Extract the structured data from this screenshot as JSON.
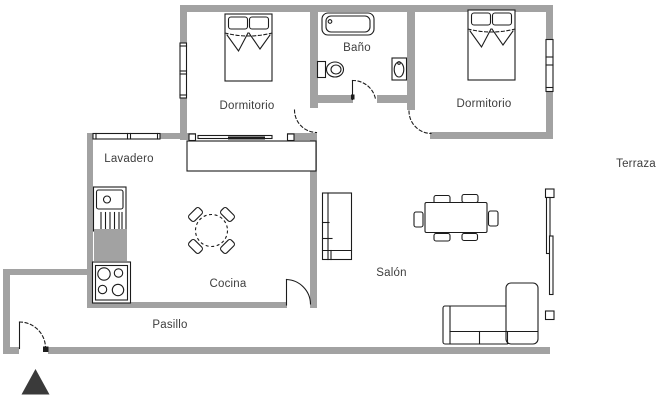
{
  "plan": {
    "rooms": {
      "dormitorio_1": "Dormitorio",
      "bano": "Baño",
      "dormitorio_2": "Dormitorio",
      "terraza": "Terraza",
      "lavadero": "Lavadero",
      "cocina": "Cocina",
      "salon": "Salón",
      "pasillo": "Pasillo"
    },
    "colors": {
      "wall": "#a2a2a2",
      "line": "#1c1c1c",
      "label": "#3d3d3d",
      "arrow": "#3a3a3a",
      "background": "#ffffff"
    },
    "furniture_icons": [
      "double-bed-icon",
      "double-bed-icon",
      "bathtub-icon",
      "toilet-icon",
      "washbasin-icon",
      "kitchen-sink-icon",
      "stove-icon",
      "kitchen-counter-icon",
      "round-table-chairs-icon",
      "dining-table-chairs-icon",
      "cabinet-icon",
      "corner-sofa-icon",
      "sliding-door-icon",
      "terrace-slider-icon",
      "window-icon",
      "door-swing-icon",
      "north-arrow-icon"
    ]
  }
}
